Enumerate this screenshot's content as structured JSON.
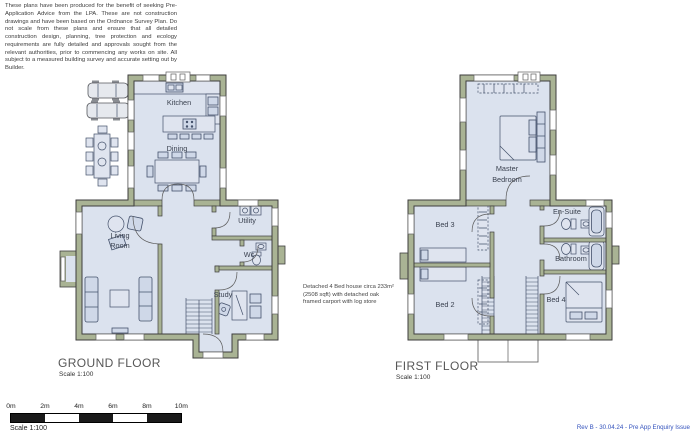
{
  "document": {
    "disclaimer": "These plans have been produced for the benefit of seeking Pre-Application Advice from the LPA. These are not construction drawings and have been based on the Ordnance Survey Plan. Do not scale from these plans and ensure that all detailed construction design, planning, tree protection and ecology requirements are fully detailed and approvals sought from the relevant authorities, prior to commencing any works on site. All subject to a measured building survey and accurate setting out by Builder.",
    "annotation": "Detached 4 Bed house circa 233m² (2508 sqft) with detached oak framed carport with log store",
    "revision": "Rev B - 30.04.24 - Pre App Enquiry Issue"
  },
  "ground_floor": {
    "title": "GROUND FLOOR",
    "scale_label": "Scale 1:100",
    "rooms": {
      "kitchen": "Kitchen",
      "dining": "Dining",
      "living_1": "Living",
      "living_2": "Room",
      "utility": "Utility",
      "wc": "Wc",
      "study": "Study"
    }
  },
  "first_floor": {
    "title": "FIRST FLOOR",
    "scale_label": "Scale 1:100",
    "rooms": {
      "master_1": "Master",
      "master_2": "Bedroom",
      "bed3": "Bed 3",
      "bed2": "Bed 2",
      "bed4": "Bed 4",
      "en_suite": "En-Suite",
      "bathroom": "Bathroom"
    }
  },
  "scale_bar": {
    "ticks": [
      "0m",
      "2m",
      "4m",
      "6m",
      "8m",
      "10m"
    ],
    "label": "Scale 1:100"
  },
  "colors": {
    "wall": "#a9b394",
    "floor": "#dbe2ee",
    "furniture_stroke": "#44516b",
    "revision_text": "#3352bd"
  }
}
